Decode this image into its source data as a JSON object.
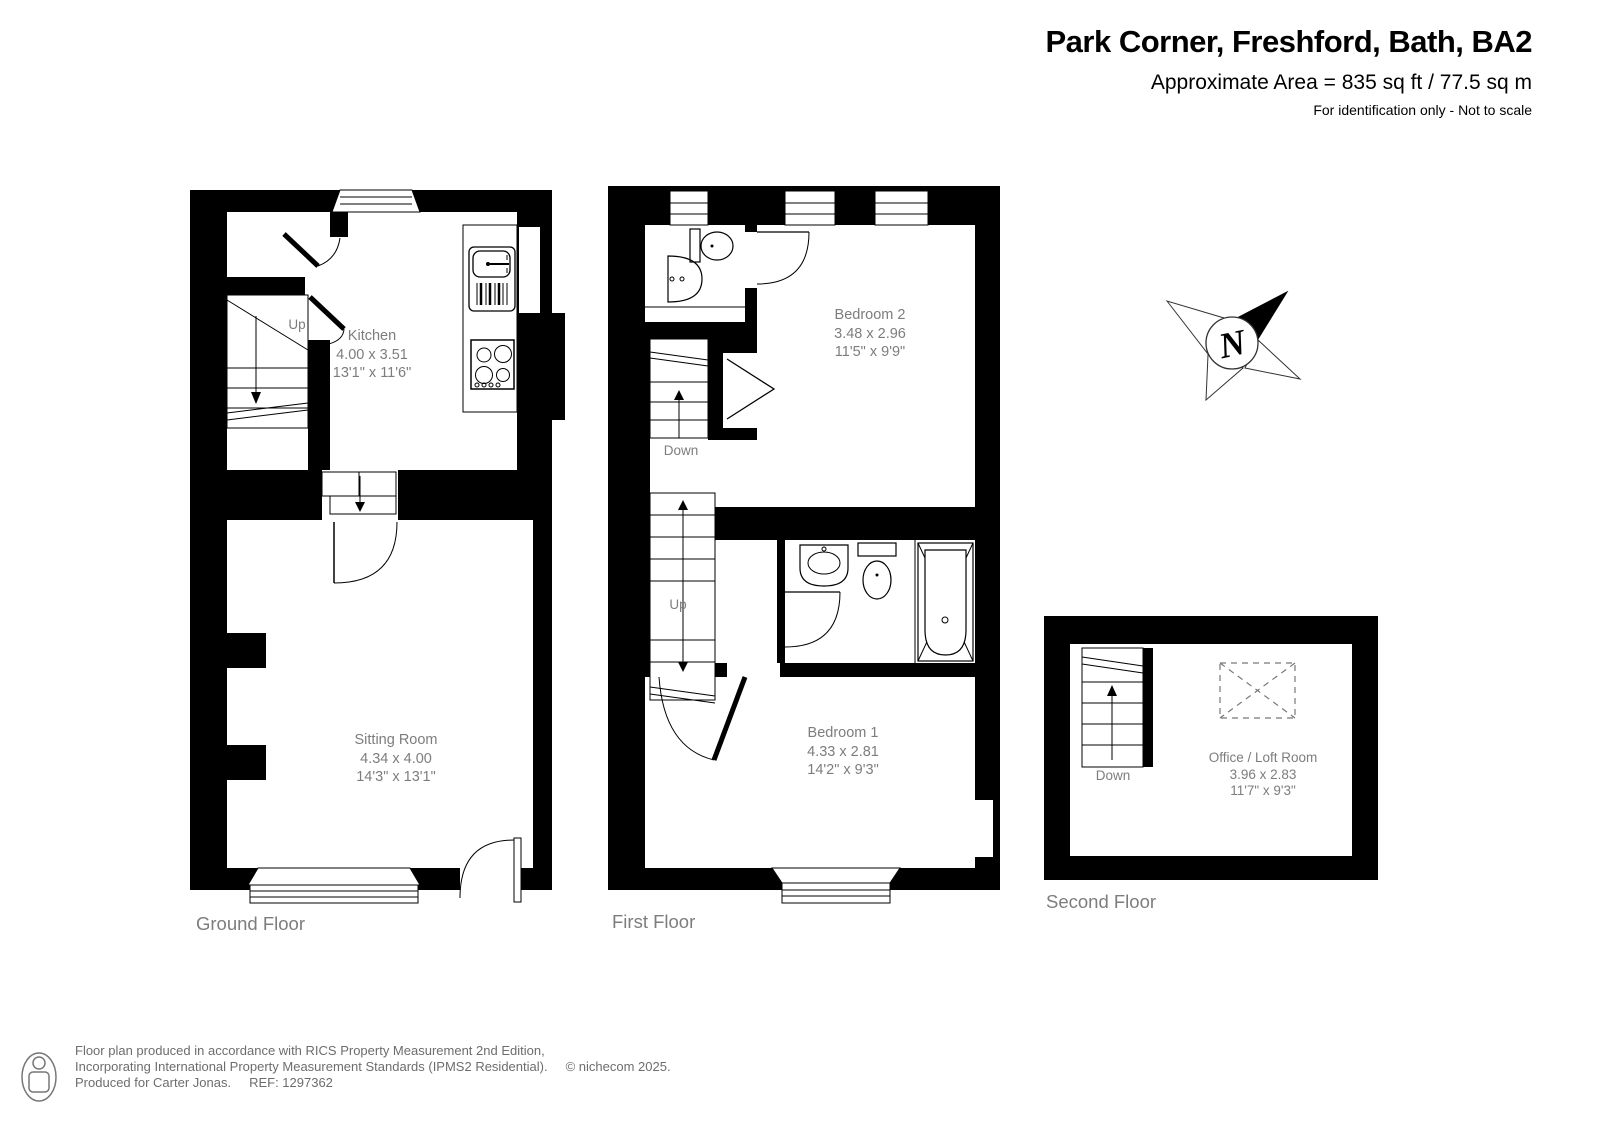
{
  "header": {
    "title": "Park Corner, Freshford, Bath, BA2",
    "area_line": "Approximate Area = 835 sq ft / 77.5 sq m",
    "disclaimer": "For identification only - Not to scale"
  },
  "compass": {
    "letter": "N"
  },
  "floors": {
    "ground": {
      "label": "Ground Floor",
      "stair_label": "Up",
      "rooms": {
        "kitchen": {
          "name": "Kitchen",
          "metric": "4.00 x 3.51",
          "imperial": "13'1\" x 11'6\""
        },
        "sitting_room": {
          "name": "Sitting Room",
          "metric": "4.34 x 4.00",
          "imperial": "14'3\" x 13'1\""
        }
      }
    },
    "first": {
      "label": "First Floor",
      "stair_down_label": "Down",
      "stair_up_label": "Up",
      "rooms": {
        "bedroom2": {
          "name": "Bedroom 2",
          "metric": "3.48 x 2.96",
          "imperial": "11'5\" x 9'9\""
        },
        "bedroom1": {
          "name": "Bedroom 1",
          "metric": "4.33 x 2.81",
          "imperial": "14'2\" x 9'3\""
        }
      }
    },
    "second": {
      "label": "Second Floor",
      "stair_label": "Down",
      "rooms": {
        "office": {
          "name": "Office / Loft Room",
          "metric": "3.96 x 2.83",
          "imperial": "11'7\" x 9'3\""
        }
      }
    }
  },
  "footer": {
    "line1": "Floor plan produced in accordance with RICS Property Measurement 2nd Edition,",
    "line2": "Incorporating International Property Measurement Standards (IPMS2 Residential).",
    "copyright": "© nichecom 2025.",
    "line3": "Produced for Carter Jonas.",
    "ref": "REF: 1297362"
  }
}
